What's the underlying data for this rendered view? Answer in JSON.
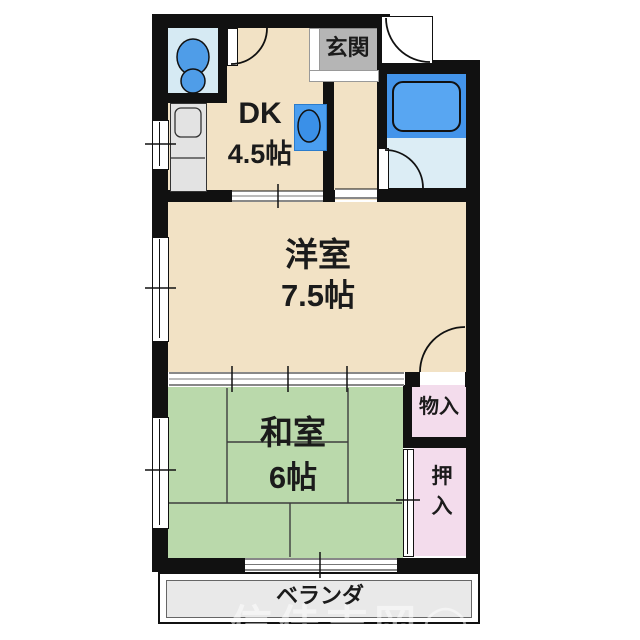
{
  "floorplan": {
    "rooms": {
      "dk": {
        "name": "DK",
        "size": "4.5帖"
      },
      "entrance": {
        "label": "玄関"
      },
      "western_room": {
        "name": "洋室",
        "size": "7.5帖"
      },
      "japanese_room": {
        "name": "和室",
        "size": "6帖"
      },
      "storage": {
        "label": "物入"
      },
      "closet": {
        "char1": "押",
        "char2": "入"
      },
      "veranda": {
        "label": "ベランダ"
      }
    },
    "fixtures": {
      "toilet_icon": "toilet",
      "bathtub_icon": "bathtub",
      "wash_basin_icon": "wash-basin",
      "kitchen_sink_icon": "kitchen-sink"
    },
    "colors": {
      "wall": "#111111",
      "room_beige": "#f2e2c5",
      "tatami_green": "#bad9ab",
      "closet_pink": "#f3dcec",
      "entrance_gray": "#b5b5b5",
      "toilet_room_blue": "#d6eaf3",
      "bath_floor_blue": "#dcedf5",
      "tub_band_blue": "#4394ea",
      "tub_blue": "#58a6f2",
      "fixture_blue": "#4a9ef0",
      "counter_gray": "#e3e3e3",
      "veranda_gray": "#e9e9e9"
    },
    "watermark": {
      "text": "信佳吉岡",
      "mark": "◯"
    }
  }
}
